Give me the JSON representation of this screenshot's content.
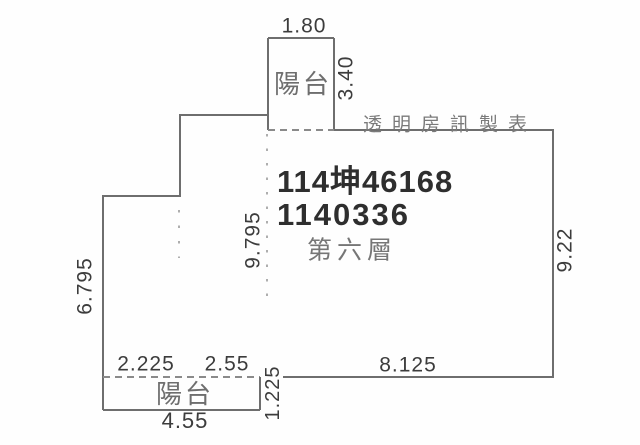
{
  "colors": {
    "wall": "#6e6e6e",
    "dash": "#8a8a8a",
    "dot": "#9a9a9a",
    "dim_text": "#3c3c3c",
    "id_text": "#2e2e2e",
    "cjk_text": "#6e6e6e",
    "header_text": "#7a7a7a",
    "background": "#fefefe"
  },
  "plan": {
    "publisher": "透明房訊製表",
    "case_id": "114坤46168",
    "case_no": "1140336",
    "floor_label": "第六層",
    "balcony_top_label": "陽台",
    "balcony_bottom_label": "陽台",
    "dims": {
      "top_balcony_width": "1.80",
      "top_balcony_height": "3.40",
      "interior_height": "9.795",
      "right_height": "9.22",
      "left_height": "6.795",
      "bottom_seg1": "2.225",
      "bottom_seg2": "2.55",
      "bottom_seg3": "8.125",
      "bottom_balcony_depth": "1.225",
      "bottom_balcony_width": "4.55"
    }
  }
}
